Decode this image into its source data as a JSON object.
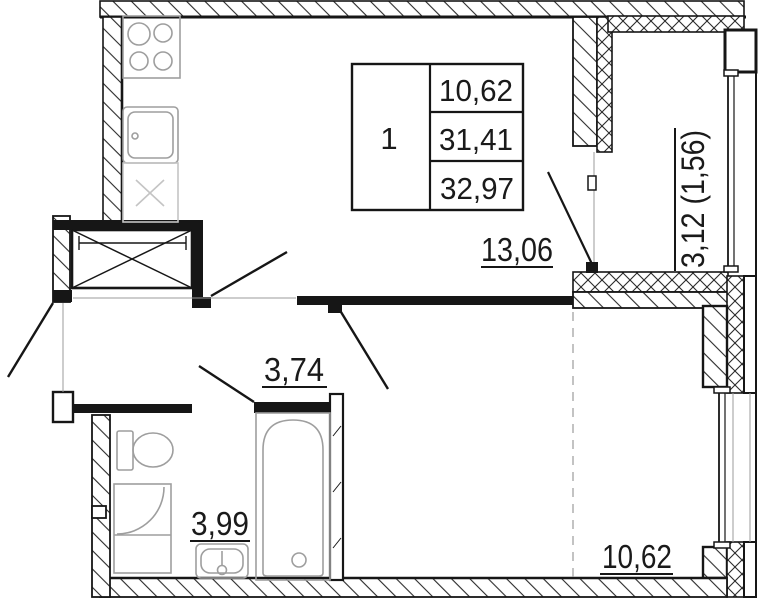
{
  "plan_title": "one-room apartment floor plan",
  "colors": {
    "line": "#161616",
    "fixture": "#9e9e9e",
    "hatch": "#2a2a2a"
  },
  "info_table": {
    "rooms_count": "1",
    "living_area": "10,62",
    "apartment_area": "31,41",
    "total_area": "32,97"
  },
  "room_labels": {
    "living_room": "13,06",
    "hallway": "3,74",
    "bathroom": "3,99",
    "bedroom": "10,62",
    "balcony": "3,12 (1,56)"
  }
}
